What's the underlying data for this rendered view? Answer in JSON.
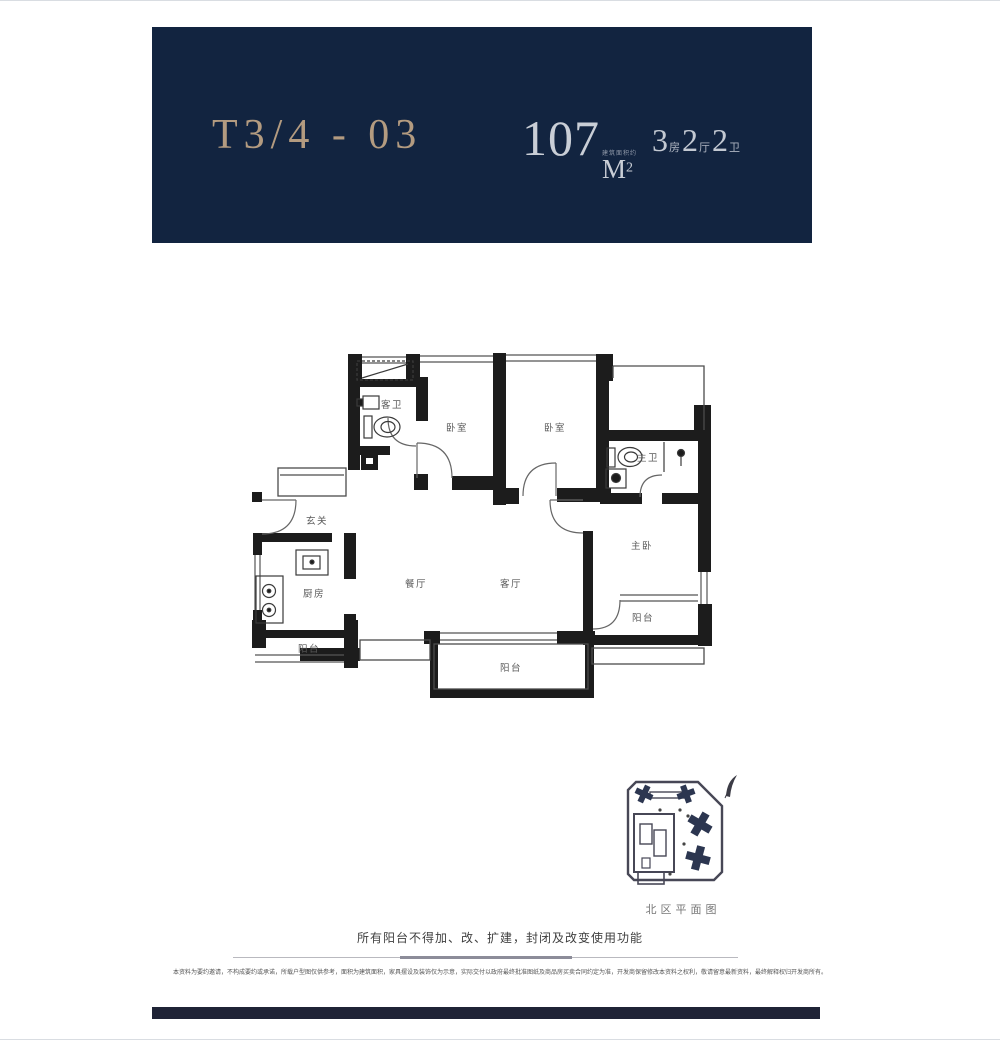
{
  "header": {
    "unit_code": "T3/4 - 03",
    "area_value": "107",
    "area_unit": "M",
    "area_sup": "2",
    "area_note": "建筑面积约",
    "layout": [
      {
        "num": "3",
        "unit": "房"
      },
      {
        "num": "2",
        "unit": "厅"
      },
      {
        "num": "2",
        "unit": "卫"
      }
    ],
    "colors": {
      "background": "#122440",
      "gold": "#b39b80",
      "silver": "#c9ced6"
    }
  },
  "floor_plan": {
    "rooms": [
      {
        "label": "客卫"
      },
      {
        "label": "卧室"
      },
      {
        "label": "卧室"
      },
      {
        "label": "主卫"
      },
      {
        "label": "玄关"
      },
      {
        "label": "厨房"
      },
      {
        "label": "餐厅"
      },
      {
        "label": "客厅"
      },
      {
        "label": "主卧"
      },
      {
        "label": "阳台"
      },
      {
        "label": "阳台"
      },
      {
        "label": "阳台"
      }
    ],
    "wall_color": "#1c1c1c"
  },
  "site_plan": {
    "caption": "北区平面图",
    "highlight_color": "#2c3650"
  },
  "footer": {
    "notice": "所有阳台不得加、改、扩建，封闭及改变使用功能",
    "fine_print": "本资料为要约邀请，不构成要约或承诺，所载户型图仅供参考，面积为建筑面积，家具摆设及装饰仅为示意，实际交付以政府最终批准图纸及商品房买卖合同约定为准，开发商保留修改本资料之权利，敬请留意最新资料，最终解释权归开发商所有。"
  }
}
